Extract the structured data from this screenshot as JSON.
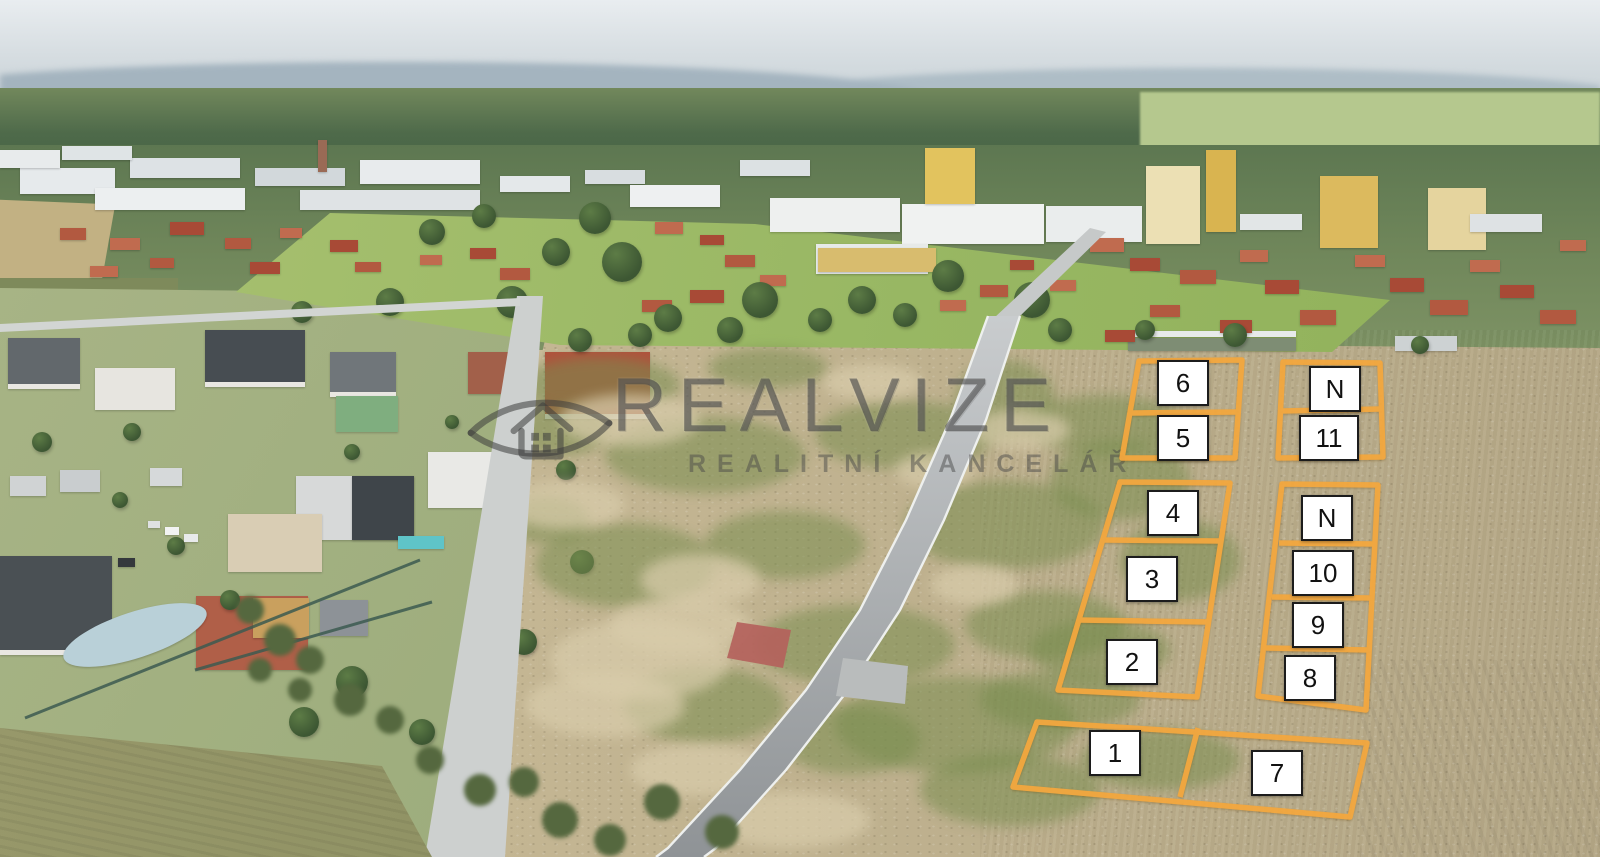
{
  "watermark": {
    "brand": "REALVIZE",
    "subtitle": "REALITNÍ KANCELÁŘ",
    "logo_icon": "eye-house-logo",
    "color": "#3C3C3C"
  },
  "overlay": {
    "outline_color": "#F3A73E",
    "label_background": "#FFFFFF",
    "label_border": "#1C1C1C",
    "label_text_color": "#111111",
    "labels": [
      {
        "id": "plot-6",
        "label": "6"
      },
      {
        "id": "plot-5",
        "label": "5"
      },
      {
        "id": "plot-n-top",
        "label": "N"
      },
      {
        "id": "plot-11",
        "label": "11"
      },
      {
        "id": "plot-4",
        "label": "4"
      },
      {
        "id": "plot-3",
        "label": "3"
      },
      {
        "id": "plot-2",
        "label": "2"
      },
      {
        "id": "plot-n-mid",
        "label": "N"
      },
      {
        "id": "plot-10",
        "label": "10"
      },
      {
        "id": "plot-9",
        "label": "9"
      },
      {
        "id": "plot-8",
        "label": "8"
      },
      {
        "id": "plot-1",
        "label": "1"
      },
      {
        "id": "plot-7",
        "label": "7"
      }
    ]
  }
}
